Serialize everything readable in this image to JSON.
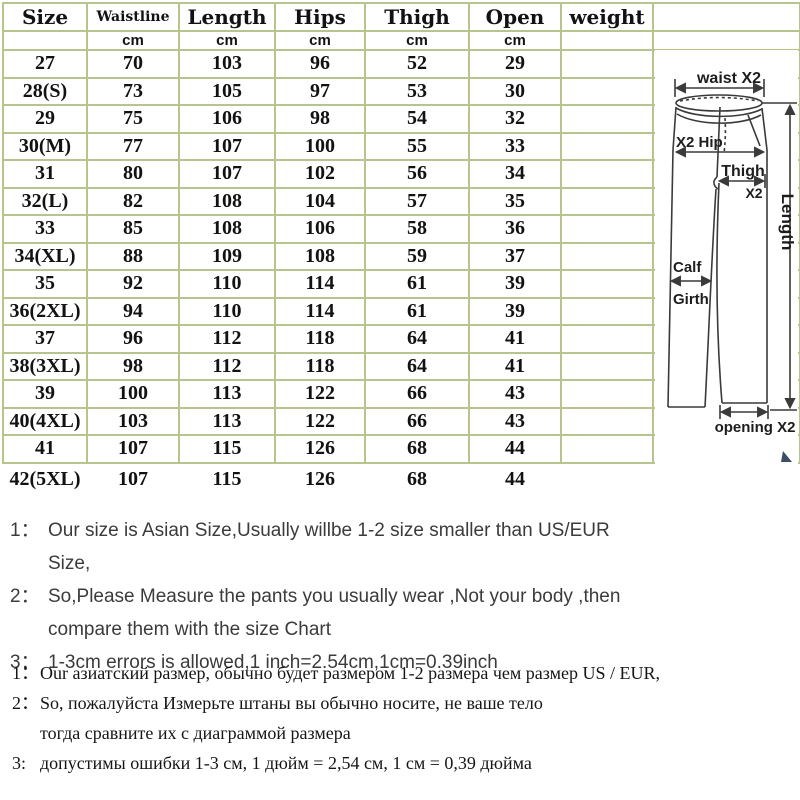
{
  "colors": {
    "grid": "#b7c48d",
    "table_text": "#121212",
    "diagram_line": "#3a3a3a",
    "note_en_text": "#3b3b3b",
    "note_ru_text": "#161616",
    "corner_artifact": "#3a4f66"
  },
  "table": {
    "columns": [
      {
        "label": "Size",
        "unit": ""
      },
      {
        "label": "Waistline",
        "unit": "cm"
      },
      {
        "label": "Length",
        "unit": "cm"
      },
      {
        "label": "Hips",
        "unit": "cm"
      },
      {
        "label": "Thigh",
        "unit": "cm"
      },
      {
        "label": "Open",
        "unit": "cm"
      },
      {
        "label": "weight",
        "unit": ""
      },
      {
        "label": "",
        "unit": ""
      }
    ],
    "rows": [
      [
        "27",
        "70",
        "103",
        "96",
        "52",
        "29",
        "",
        ""
      ],
      [
        "28(S)",
        "73",
        "105",
        "97",
        "53",
        "30",
        "",
        ""
      ],
      [
        "29",
        "75",
        "106",
        "98",
        "54",
        "32",
        "",
        ""
      ],
      [
        "30(M)",
        "77",
        "107",
        "100",
        "55",
        "33",
        "",
        ""
      ],
      [
        "31",
        "80",
        "107",
        "102",
        "56",
        "34",
        "",
        ""
      ],
      [
        "32(L)",
        "82",
        "108",
        "104",
        "57",
        "35",
        "",
        ""
      ],
      [
        "33",
        "85",
        "108",
        "106",
        "58",
        "36",
        "",
        ""
      ],
      [
        "34(XL)",
        "88",
        "109",
        "108",
        "59",
        "37",
        "",
        ""
      ],
      [
        "35",
        "92",
        "110",
        "114",
        "61",
        "39",
        "",
        ""
      ],
      [
        "36(2XL)",
        "94",
        "110",
        "114",
        "61",
        "39",
        "",
        ""
      ],
      [
        "37",
        "96",
        "112",
        "118",
        "64",
        "41",
        "",
        ""
      ],
      [
        "38(3XL)",
        "98",
        "112",
        "118",
        "64",
        "41",
        "",
        ""
      ],
      [
        "39",
        "100",
        "113",
        "122",
        "66",
        "43",
        "",
        ""
      ],
      [
        "40(4XL)",
        "103",
        "113",
        "122",
        "66",
        "43",
        "",
        ""
      ],
      [
        "41",
        "107",
        "115",
        "126",
        "68",
        "44",
        "",
        ""
      ]
    ],
    "footer_row": [
      "42(5XL)",
      "107",
      "115",
      "126",
      "68",
      "44",
      "",
      ""
    ]
  },
  "diagram": {
    "labels": {
      "waist": "waist X2",
      "hip": "X2 Hip",
      "thigh": "Thigh",
      "thigh_x2": "X2",
      "length": "Length",
      "calf": "Calf",
      "girth": "Girth",
      "opening": "opening X2"
    }
  },
  "notes_en": [
    {
      "prefix": "1：",
      "lines": [
        "Our size is Asian Size,Usually willbe 1-2 size smaller than US/EUR Size,"
      ]
    },
    {
      "prefix": "2：",
      "lines": [
        "So,Please Measure the pants you usually wear ,Not your body ,then",
        "compare them with the size Chart"
      ]
    },
    {
      "prefix": "3：",
      "lines": [
        "1-3cm errors is allowed,1 inch=2.54cm,1cm=0.39inch"
      ]
    }
  ],
  "notes_ru": [
    {
      "prefix": "1：",
      "lines": [
        "Our азиатский размер, обычно будет размером 1-2 размера чем размер US / EUR,"
      ]
    },
    {
      "prefix": "2：",
      "lines": [
        "So, пожалуйста Измерьте штаны вы обычно носите, не ваше тело",
        "тогда сравните их с диаграммой размера"
      ]
    },
    {
      "prefix": "3:",
      "lines": [
        "допустимы ошибки 1-3 см, 1 дюйм = 2,54 см, 1 см = 0,39 дюйма"
      ]
    }
  ]
}
